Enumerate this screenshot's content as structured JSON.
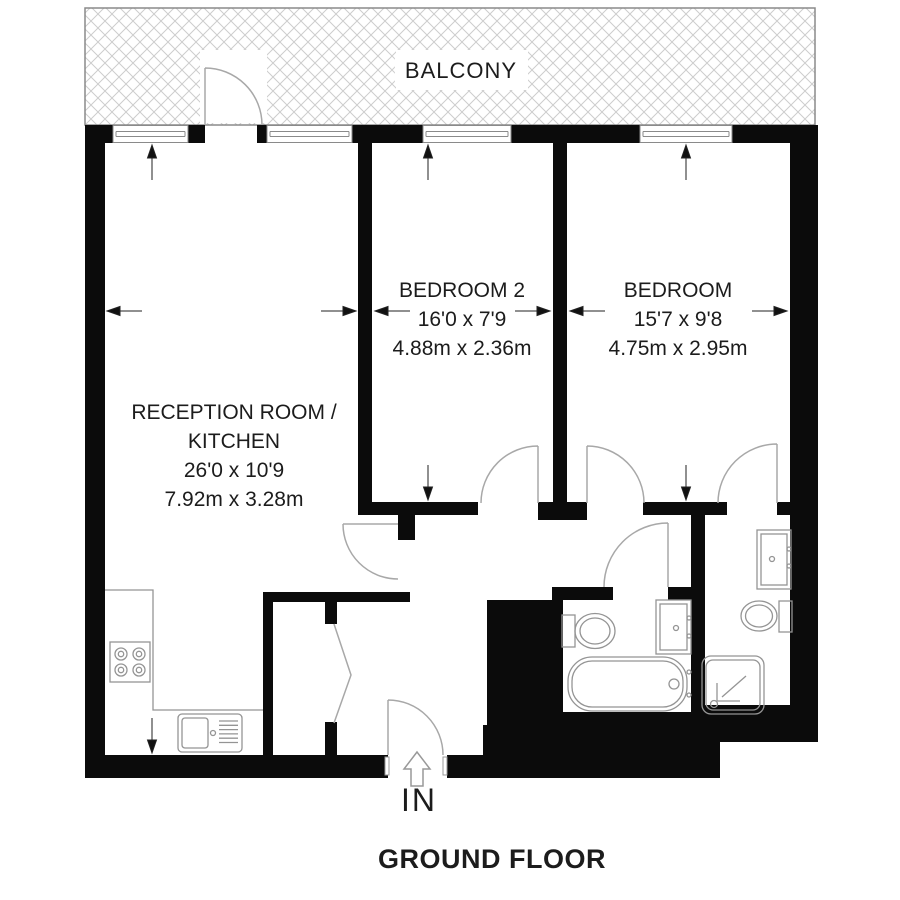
{
  "floorplan": {
    "title": "GROUND FLOOR",
    "balcony_label": "BALCONY",
    "entrance_label": "IN",
    "rooms": {
      "reception": {
        "line1": "RECEPTION ROOM /",
        "line2": "KITCHEN",
        "imperial": "26'0 x 10'9",
        "metric": "7.92m x 3.28m"
      },
      "bedroom2": {
        "name": "BEDROOM 2",
        "imperial": "16'0 x 7'9",
        "metric": "4.88m x 2.36m"
      },
      "bedroom": {
        "name": "BEDROOM",
        "imperial": "15'7 x 9'8",
        "metric": "4.75m x 2.95m"
      }
    },
    "fixtures": [
      "hob",
      "kitchen-sink",
      "wardrobe",
      "toilet",
      "wash-basin",
      "bathtub",
      "toilet",
      "wash-basin",
      "shower-tray"
    ],
    "colors": {
      "wall": "#0b0b0b",
      "thin_line": "#9b9b9b",
      "door_line": "#a8a8a8",
      "hatch": "#cdcdcd",
      "text": "#1c1c1c"
    }
  }
}
